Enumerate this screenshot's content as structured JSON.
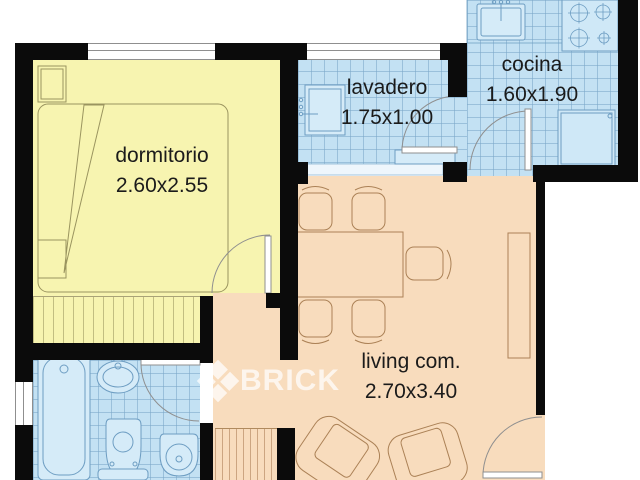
{
  "plan_title": "apartment floor plan",
  "rooms": {
    "dormitorio": {
      "label": "dormitorio",
      "dims": "2.60x2.55"
    },
    "lavadero": {
      "label": "lavadero",
      "dims": "1.75x1.00"
    },
    "cocina": {
      "label": "cocina",
      "dims": "1.60x1.90"
    },
    "living": {
      "label": "living com.",
      "dims": "2.70x3.40"
    }
  },
  "watermark": {
    "brand": "BRICK"
  },
  "colors": {
    "bedroom_floor": "#f7f4b0",
    "wet_room_tile": "#c3e1f3",
    "living_floor": "#f8dcbd",
    "walls": "#0b0b0b",
    "watermark": "rgba(255,255,255,0.72)"
  }
}
